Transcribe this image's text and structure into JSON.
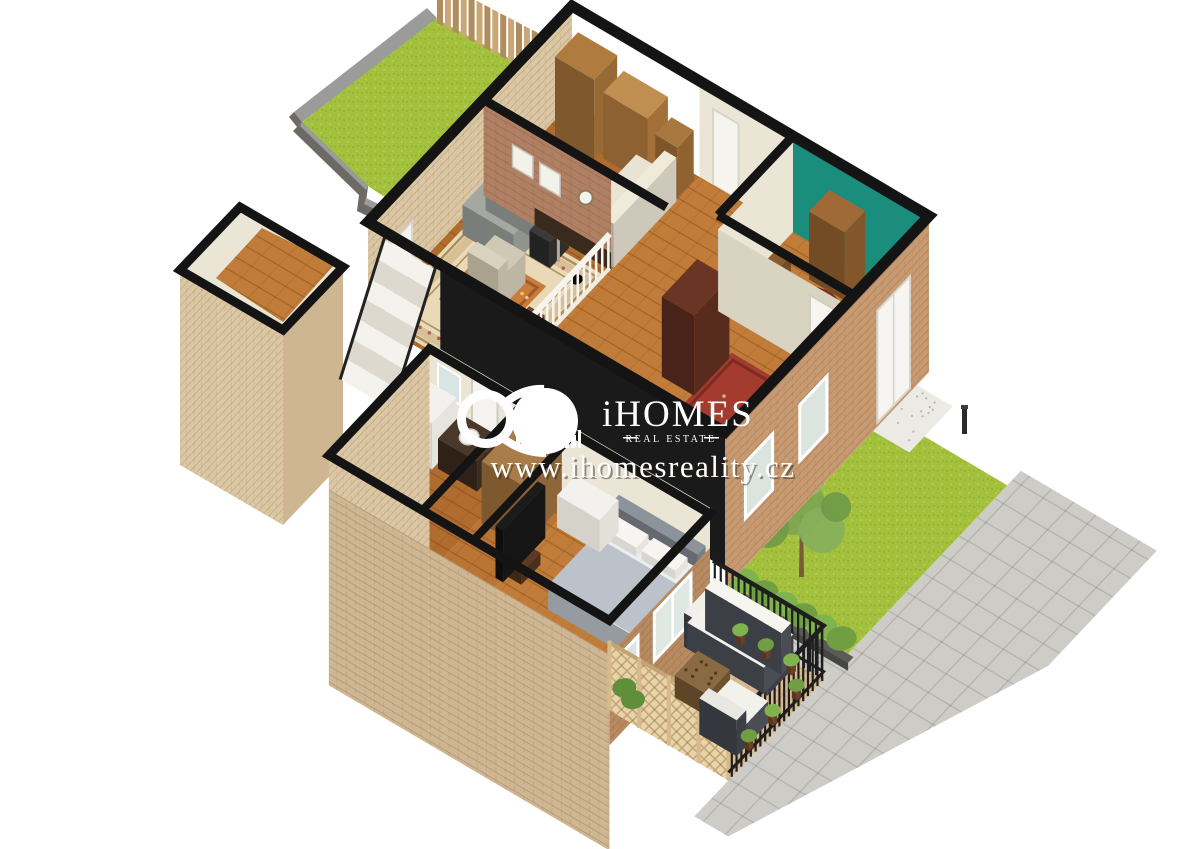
{
  "watermark": {
    "brand": "iHOMES",
    "tagline": "REAL ESTATE",
    "url": "www.ihomesreality.cz"
  },
  "scene": {
    "type": "3d-isometric-floor-plan-rendering",
    "elements": [
      "garden-lawn",
      "stone-garden-wall",
      "wooden-fence",
      "storage-room",
      "staircase",
      "sitting-room",
      "cream-sofa",
      "bookshelves",
      "picture-wall",
      "window-wall",
      "living-room",
      "ornate-area-rug",
      "gray-sofa",
      "armchair",
      "dining-table",
      "dining-chairs",
      "white-railing",
      "corridor",
      "runner-rug",
      "armoire",
      "entrance-hall",
      "teal-accent-wall",
      "round-red-rug",
      "console-table",
      "wall-shelf",
      "bathroom",
      "washing-machine",
      "vanity-sink",
      "mirror",
      "closet-shelves",
      "bedroom",
      "double-bed",
      "dresser",
      "tv-stand",
      "french-doors",
      "front-door",
      "porch-step",
      "front-yard-lawn",
      "tree",
      "hedge-row",
      "paved-patio",
      "bollard-light",
      "terrace",
      "outdoor-sofa",
      "coffee-table",
      "lounge-chair",
      "lattice-fence",
      "metal-railing",
      "potted-plants"
    ]
  },
  "colors": {
    "background": "#ffffff",
    "wallBlack": "#141414",
    "cream": "#ebe5d6",
    "creamShade": "#d9d3c2",
    "paleBrick": "#dbc7a4",
    "paleBrick2": "#cdb691",
    "tanBrick": "#c79a72",
    "tanBrick2": "#b88a62",
    "redBrick": "#b08064",
    "woodFloor": "#b06c2e",
    "woodFloor2": "#c07c38",
    "woodShelf": "#b07b3e",
    "grass": "#a4c13d",
    "grassDark": "#96b335",
    "grassLight": "#b3cc55",
    "stoneTop": "#9b9b9b",
    "stoneSide": "#6d6a66",
    "fence": "#c9a878",
    "fenceDark": "#b08d5e",
    "teal": "#1b8d7c",
    "rugField": "#ead9b6",
    "rugBorder": "#d8c096",
    "rugLine": "#ad8f5f",
    "rugRose": "#c993a2",
    "rugRed": "#b05548",
    "rugOrange": "#c87b3a",
    "rugPurple": "#96566a",
    "runnerRed": "#a33b2e",
    "graySofa": "#a3a8a2",
    "creamSofa": "#e9e3d3",
    "darkWood": "#5c3a22",
    "armoire": "#6a3524",
    "bedDuvet": "#bcc2ca",
    "bedFrame": "#8d939b",
    "whiteFurn": "#f2f1ed",
    "terraceTile": "#d9b98f",
    "paver": "#cdccc7",
    "hedge": "#6f9f42",
    "hedgeLight": "#7fb34f",
    "tree": "#7da653",
    "railBlack": "#1e1e1e",
    "lattice": "#e8d4aa",
    "latticeLine": "#c3a474",
    "white": "#ffffff"
  }
}
